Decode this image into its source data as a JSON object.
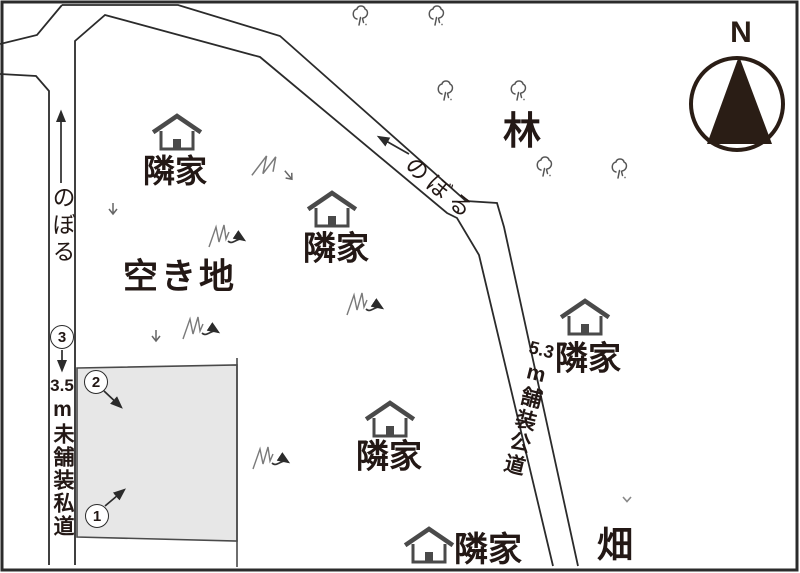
{
  "colors": {
    "ink": "#2b2b2b",
    "text": "#231815",
    "fill": "#e7e7e7",
    "house": "#4a4a4a",
    "compass": "#2a1d15"
  },
  "compass": {
    "label": "N"
  },
  "roads": {
    "left_private": {
      "slope_label": "のぼる",
      "marker": "3",
      "width": "3.5",
      "name": "m未舗装私道"
    },
    "top_slope": {
      "slope_label": "のぼる"
    },
    "right_public": {
      "width": "5.3",
      "name": "m舗装公道"
    }
  },
  "areas": {
    "vacant_lot": "空き地",
    "forest": "林",
    "field": "畑"
  },
  "property_markers": {
    "m1": "1",
    "m2": "2"
  },
  "houses": [
    {
      "label": "隣家"
    },
    {
      "label": "隣家"
    },
    {
      "label": "隣家"
    },
    {
      "label": "隣家"
    },
    {
      "label": "隣家"
    }
  ],
  "icons": {
    "house": "house-icon",
    "tree": "tree-icon",
    "grass": "grass-tuft-icon",
    "compass": "compass-north-icon",
    "slope_arrow": "slope-direction-arrow"
  }
}
